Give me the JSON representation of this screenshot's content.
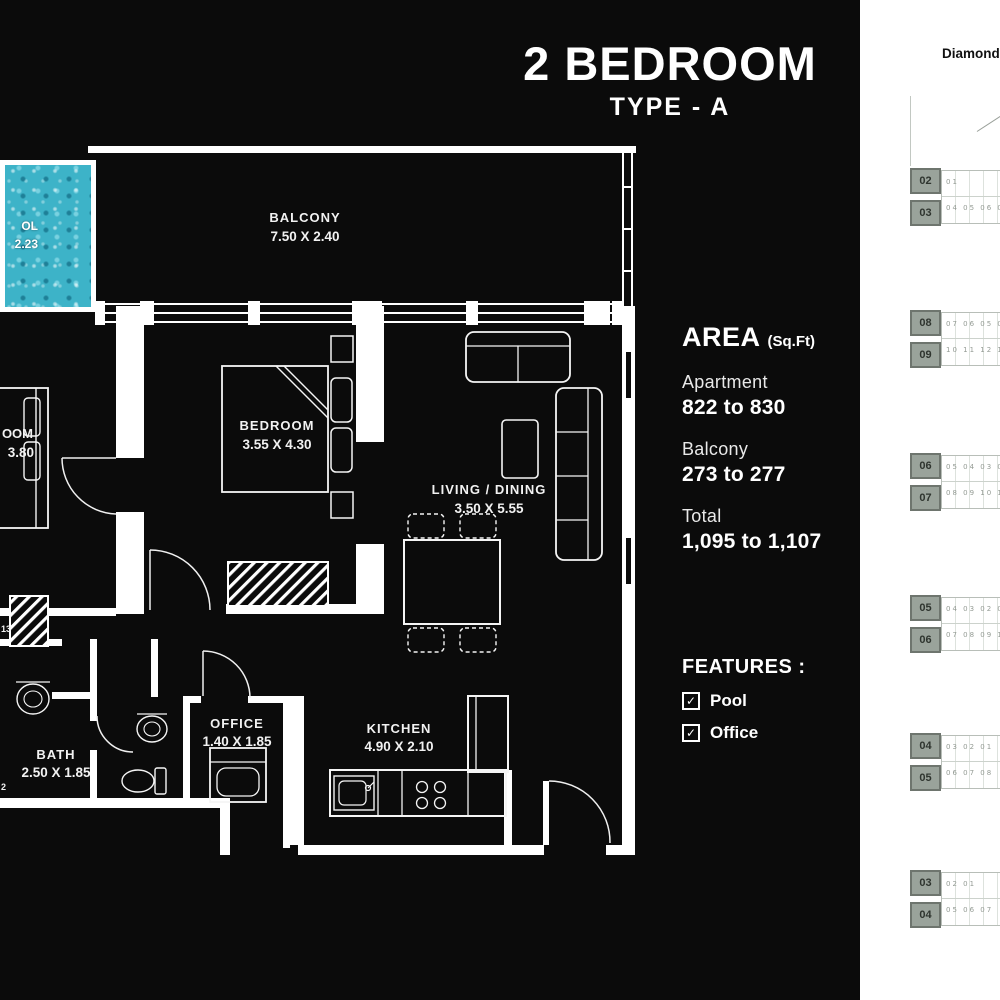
{
  "title": {
    "main": "2 BEDROOM",
    "sub": "TYPE - A"
  },
  "brand": "Diamondz",
  "pool": {
    "line1": "OL",
    "line2": "2.23"
  },
  "rooms": {
    "balcony": {
      "name": "BALCONY",
      "dim": "7.50 X 2.40"
    },
    "bedroom": {
      "name": "BEDROOM",
      "dim": "3.55 X 4.30"
    },
    "bedroom_left": {
      "name_fragment": "OOM",
      "dim_fragment": "3.80"
    },
    "living": {
      "name": "LIVING / DINING",
      "dim": "3.50 X 5.55"
    },
    "office": {
      "name": "OFFICE",
      "dim": "1.40 X 1.85"
    },
    "kitchen": {
      "name": "KITCHEN",
      "dim": "4.90 X 2.10"
    },
    "bath": {
      "name": "BATH",
      "dim": "2.50 X 1.85"
    }
  },
  "fragments": {
    "f1": "13",
    "f2": "2"
  },
  "area": {
    "heading": "AREA",
    "unit": "(Sq.Ft)",
    "rows": [
      {
        "label": "Apartment",
        "value": "822 to 830"
      },
      {
        "label": "Balcony",
        "value": "273 to 277"
      },
      {
        "label": "Total",
        "value": "1,095 to 1,107"
      }
    ]
  },
  "features": {
    "heading": "FEATURES :",
    "items": [
      "Pool",
      "Office"
    ]
  },
  "icons": {
    "check": "✓"
  },
  "keyplans": [
    {
      "units": [
        "02",
        "03"
      ],
      "row1": "01",
      "row2": "04 05 06 07 08 09"
    },
    {
      "units": [
        "08",
        "09"
      ],
      "row1": "07 06 05 04 03 02 01",
      "row2": "10 11 12 13 14 15 16"
    },
    {
      "units": [
        "06",
        "07"
      ],
      "row1": "05 04 03 02 01",
      "row2": "08 09 10 11 12"
    },
    {
      "units": [
        "05",
        "06"
      ],
      "row1": "04 03 02 01",
      "row2": "07 08 09 10"
    },
    {
      "units": [
        "04",
        "05"
      ],
      "row1": "03 02 01",
      "row2": "06 07 08"
    },
    {
      "units": [
        "03",
        "04"
      ],
      "row1": "02 01",
      "row2": "05 06 07"
    }
  ],
  "colors": {
    "panel_bg": "#0b0b0b",
    "line": "#ffffff",
    "pool": "#3db3c8",
    "side_bg": "#ffffff",
    "keyplan_fill": "#9aa39b",
    "keyplan_border": "#6e756e"
  }
}
